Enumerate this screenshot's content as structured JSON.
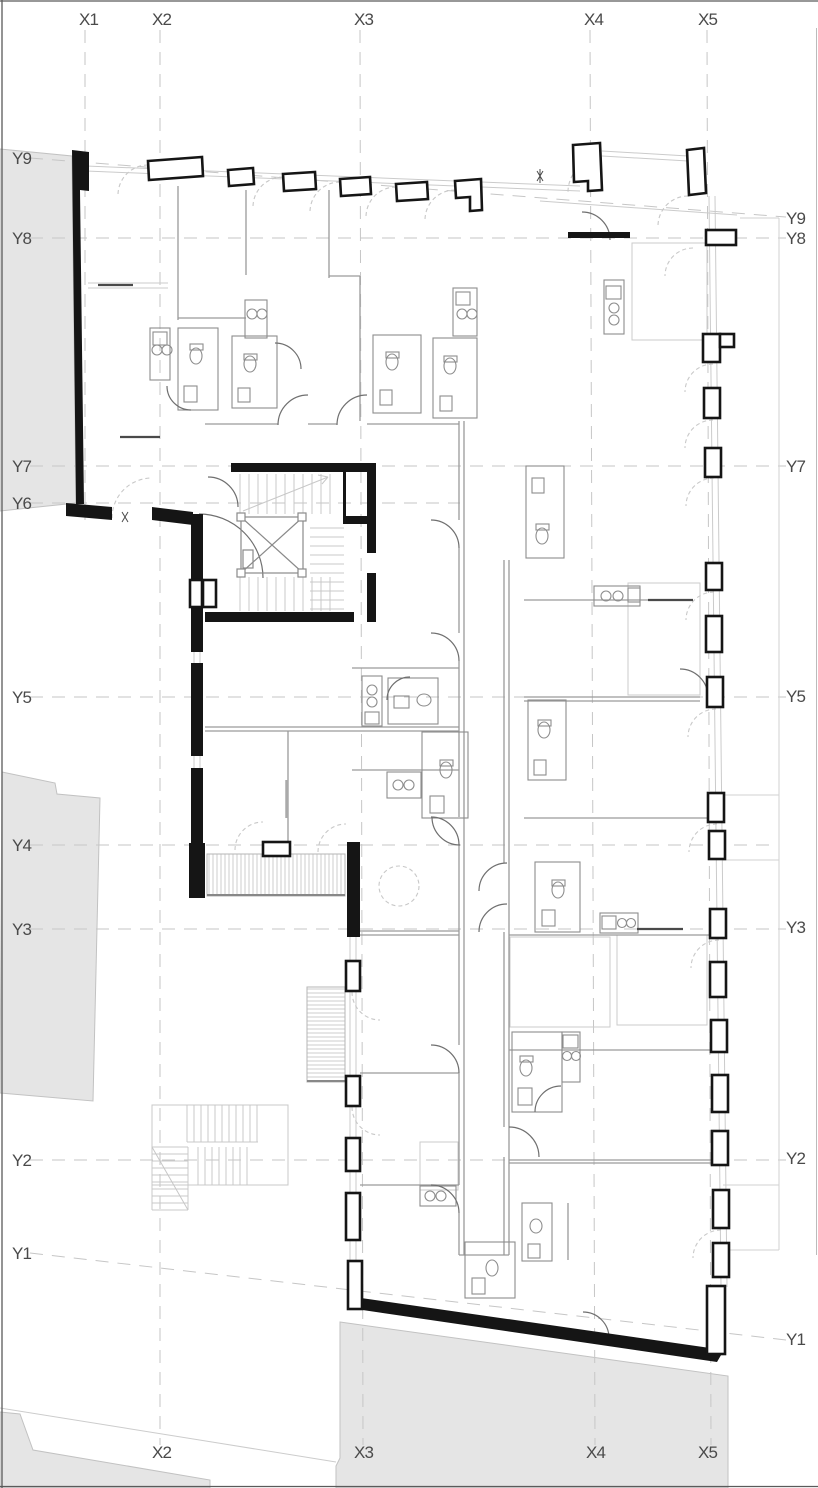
{
  "grid": {
    "x_top": [
      "X1",
      "X2",
      "X3",
      "X4",
      "X5"
    ],
    "x_bottom": [
      "X2",
      "X3",
      "X4",
      "X5"
    ],
    "y_left": [
      "Y9",
      "Y8",
      "Y7",
      "Y6",
      "Y5",
      "Y4",
      "Y3",
      "Y2",
      "Y1"
    ],
    "y_right": [
      "Y9",
      "Y8",
      "Y7",
      "Y5",
      "Y3",
      "Y2",
      "Y1"
    ]
  },
  "palette": {
    "background": "#ffffff",
    "wall": "#151515",
    "site_fill": "#e5e5e5",
    "site_edge": "#c2c2c2",
    "grid_line": "#c6c6c6",
    "partition": "#9a9a9a",
    "fixture": "#8d8d8d",
    "door_arc": "#6f6f6f",
    "light_detail": "#cbcbcb",
    "label_text": "#4a4a4a"
  }
}
